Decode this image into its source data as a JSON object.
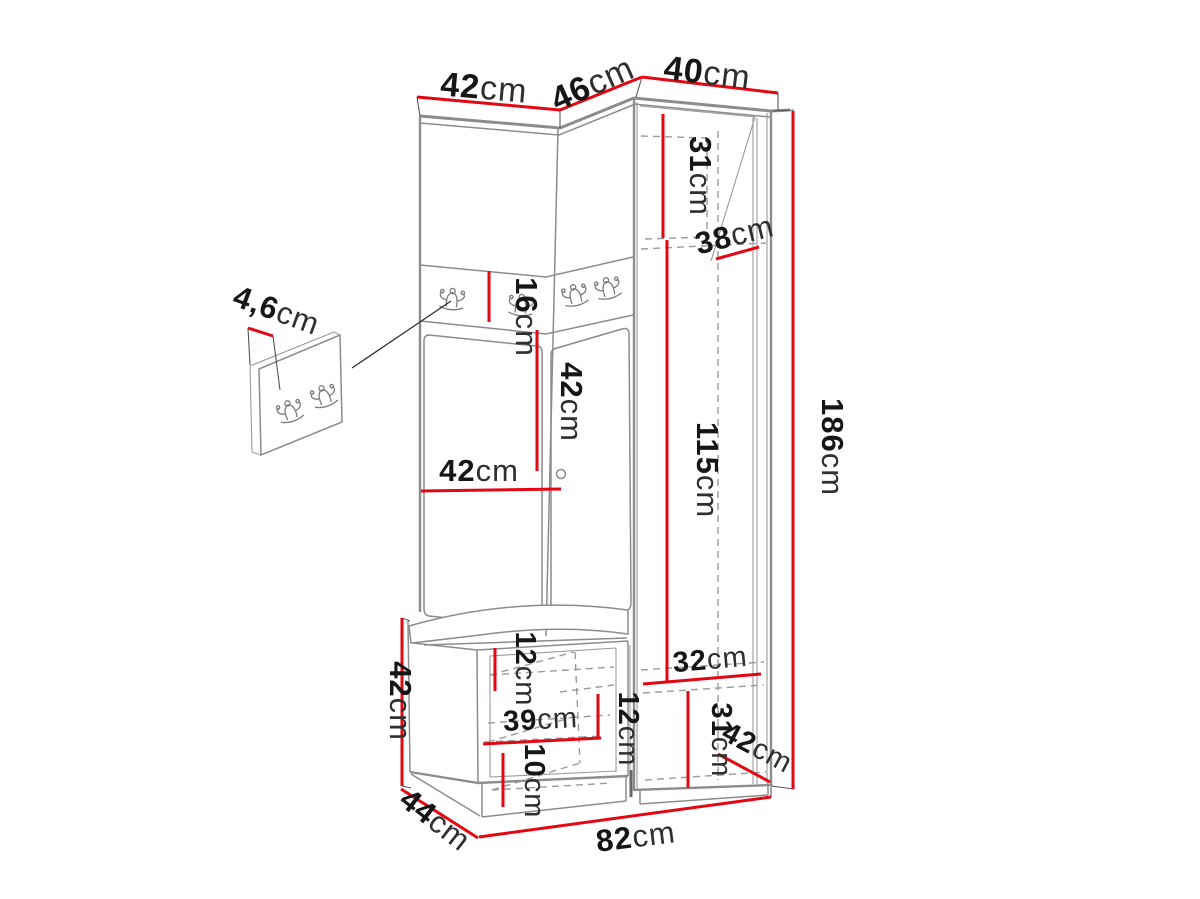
{
  "diagram": {
    "title": "Hallway furniture set dimension diagram",
    "unit_system": "cm",
    "colors": {
      "dimension_line": "#e30613",
      "drawing_line": "#8c8c8c",
      "text": "#161616",
      "background": "#ffffff"
    },
    "dimensions": {
      "top_left_width": {
        "value": "42",
        "unit": "cm"
      },
      "top_corner_width": {
        "value": "46",
        "unit": "cm"
      },
      "top_right_width": {
        "value": "40",
        "unit": "cm"
      },
      "upper_cabinet_inner_height": {
        "value": "31",
        "unit": "cm"
      },
      "upper_cabinet_depth": {
        "value": "38",
        "unit": "cm"
      },
      "hook_rail_height": {
        "value": "16",
        "unit": "cm"
      },
      "back_panel_height": {
        "value": "42",
        "unit": "cm"
      },
      "back_panel_width": {
        "value": "42",
        "unit": "cm"
      },
      "wardrobe_inner_height": {
        "value": "115",
        "unit": "cm"
      },
      "total_height": {
        "value": "186",
        "unit": "cm"
      },
      "wall_panel_thickness": {
        "value": "4,6",
        "unit": "cm"
      },
      "bench_height": {
        "value": "42",
        "unit": "cm"
      },
      "bench_top_inset": {
        "value": "12",
        "unit": "cm"
      },
      "bench_inner_width": {
        "value": "39",
        "unit": "cm"
      },
      "bench_shelf_spacing": {
        "value": "12",
        "unit": "cm"
      },
      "bench_bottom_inset": {
        "value": "10",
        "unit": "cm"
      },
      "lower_cabinet_inner_width": {
        "value": "32",
        "unit": "cm"
      },
      "lower_cabinet_inner_height": {
        "value": "31",
        "unit": "cm"
      },
      "lower_cabinet_depth": {
        "value": "42",
        "unit": "cm"
      },
      "bench_depth": {
        "value": "44",
        "unit": "cm"
      },
      "total_width": {
        "value": "82",
        "unit": "cm"
      }
    }
  }
}
